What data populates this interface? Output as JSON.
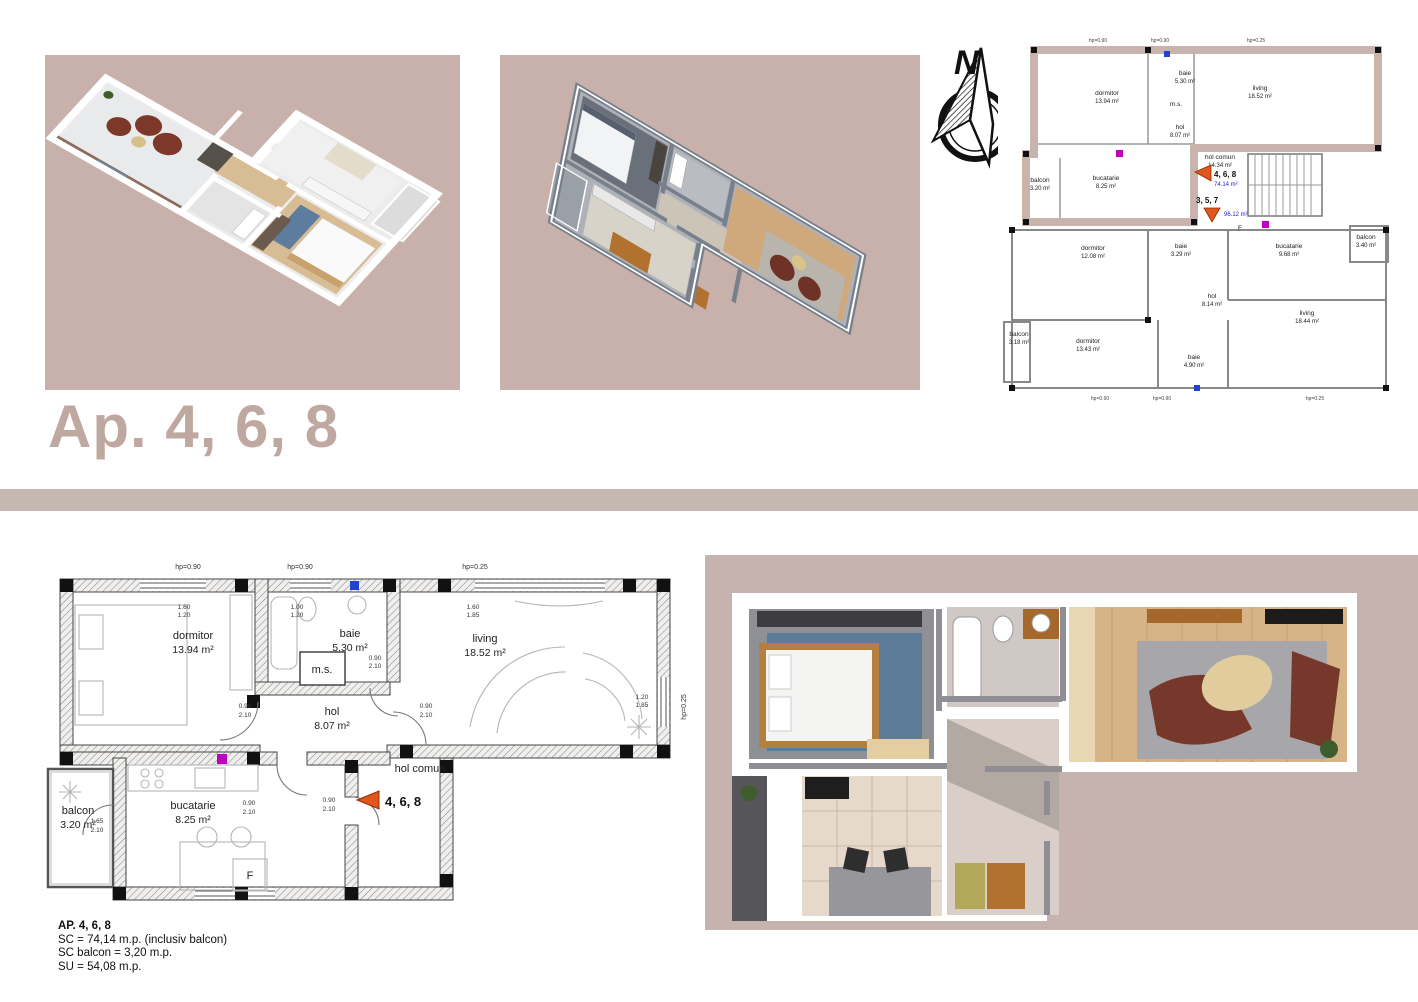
{
  "page": {
    "title": "Ap. 4, 6, 8"
  },
  "colors": {
    "accent": "#bfa8a0",
    "divider_band": "#c4b8b1",
    "render_background": "#c8b1ab",
    "highlight_wall": "#c9b3ad",
    "marker_orange": "#e0561c",
    "area_blue": "#2323d6",
    "utility_magenta": "#c000c0",
    "utility_blue": "#2244cc"
  },
  "compass": {
    "label": "N"
  },
  "site_plan": {
    "hp_top": [
      "hp=0.90",
      "hp=0.90",
      "hp=0.25"
    ],
    "hp_bottom": [
      "hp=0.90",
      "hp=0.90",
      "hp=0.25"
    ],
    "upper": {
      "rooms": [
        {
          "name": "dormitor",
          "area": "13.94 m²"
        },
        {
          "name": "baie",
          "area": "5.30 m²"
        },
        {
          "name": "living",
          "area": "18.52 m²"
        },
        {
          "name": "hol",
          "area": "8.07 m²"
        },
        {
          "name": "hol comun",
          "area": "14.34 m²"
        },
        {
          "name": "bucatarie",
          "area": "8.25 m²"
        },
        {
          "name": "balcon",
          "area": "3.20 m²"
        }
      ],
      "ms_label": "m.s.",
      "f_label": "F"
    },
    "lower": {
      "rooms": [
        {
          "name": "dormitor",
          "area": "12.08 m²"
        },
        {
          "name": "baie",
          "area": "3.29 m²"
        },
        {
          "name": "bucatarie",
          "area": "9.68 m²"
        },
        {
          "name": "balcon",
          "area": "3.40 m²"
        },
        {
          "name": "hol",
          "area": "8.14 m²"
        },
        {
          "name": "dormitor",
          "area": "13.43 m²"
        },
        {
          "name": "baie",
          "area": "4.90 m²"
        },
        {
          "name": "living",
          "area": "18.44 m²"
        },
        {
          "name": "balcon",
          "area": "3.18 m²"
        }
      ]
    },
    "markers": {
      "current": {
        "label": "4, 6, 8",
        "area": "74.14 m²"
      },
      "other": {
        "label": "3, 5, 7",
        "area": "96.12 m²"
      }
    }
  },
  "floor_plan": {
    "rooms": [
      {
        "name": "dormitor",
        "area": "13.94 m²"
      },
      {
        "name": "baie",
        "area": "5.30 m²"
      },
      {
        "name": "living",
        "area": "18.52 m²"
      },
      {
        "name": "hol",
        "area": "8.07 m²"
      },
      {
        "name": "bucatarie",
        "area": "8.25 m²"
      },
      {
        "name": "balcon",
        "area": "3.20 m²"
      }
    ],
    "ms_label": "m.s.",
    "f_label": "F",
    "hol_comun_label": "hol comun",
    "marker": {
      "label": "4, 6, 8"
    },
    "hp_top": [
      "hp=0.90",
      "hp=0.90",
      "hp=0.25"
    ],
    "hp_right": "hp=0.25",
    "dims": [
      {
        "a": "1.60",
        "b": "1.20"
      },
      {
        "a": "1.00",
        "b": "1.20"
      },
      {
        "a": "1.60",
        "b": "1.85"
      },
      {
        "a": "1.20",
        "b": "1.85"
      },
      {
        "a": "0.90",
        "b": "2.10"
      },
      {
        "a": "0.90",
        "b": "2.10"
      },
      {
        "a": "0.90",
        "b": "2.10"
      },
      {
        "a": "0.90",
        "b": "2.10"
      },
      {
        "a": "0.90",
        "b": "2.10"
      },
      {
        "a": "1.65",
        "b": "2.10"
      }
    ]
  },
  "summary": {
    "line1": "AP. 4, 6, 8",
    "line2": "SC =  74,14 m.p. (inclusiv balcon)",
    "line3": "SC balcon = 3,20 m.p.",
    "line4": "SU = 54,08 m.p."
  }
}
